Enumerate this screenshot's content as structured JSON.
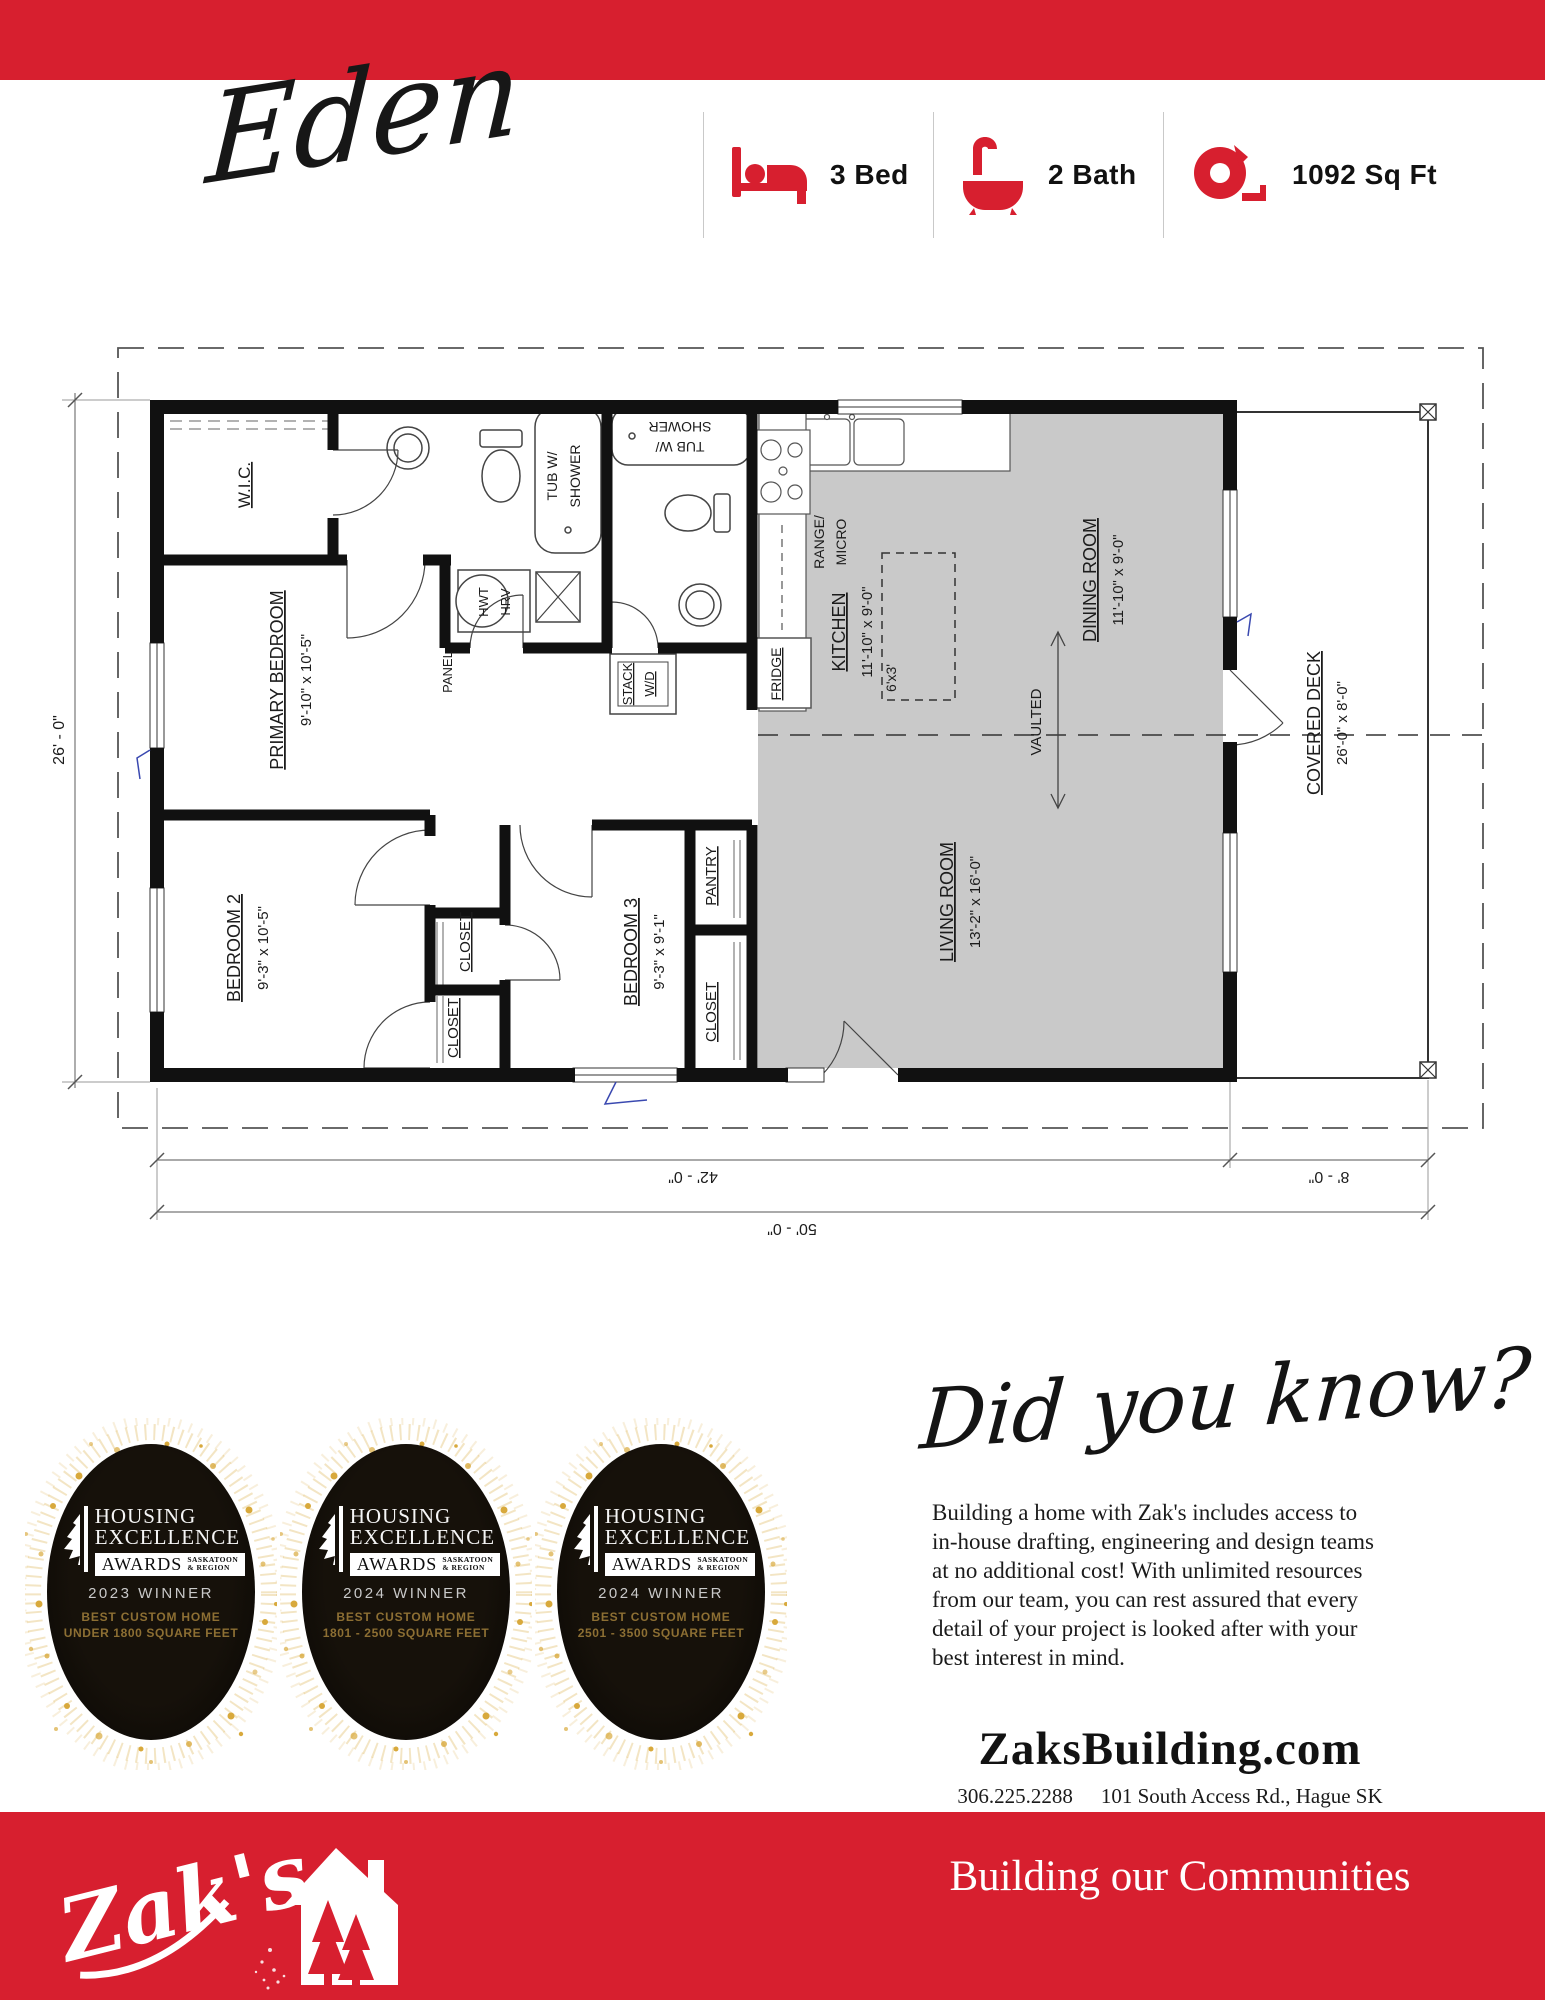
{
  "page": {
    "accent_color": "#d71f2f",
    "plan_gray": "#c9c9c9"
  },
  "header": {
    "plan_name": "Eden"
  },
  "specs": {
    "bed_label": "3 Bed",
    "bath_label": "2 Bath",
    "sqft_label": "1092 Sq Ft"
  },
  "plan": {
    "texts": [
      {
        "t": "W.I.C."
      },
      {
        "t": "PRIMARY BEDROOM"
      },
      {
        "t": "9'-10\" x 10'-5\""
      },
      {
        "t": "BEDROOM 2"
      },
      {
        "t": "9'-3\" x 10'-5\""
      },
      {
        "t": "BEDROOM 3"
      },
      {
        "t": "9'-3\" x 9'-1\""
      },
      {
        "t": "CLOSET"
      },
      {
        "t": "CLOSET"
      },
      {
        "t": "PANTRY"
      },
      {
        "t": "CLOSET"
      },
      {
        "t": "KITCHEN"
      },
      {
        "t": "11'-10\" x 9'-0\""
      },
      {
        "t": "6'x3'"
      },
      {
        "t": "DINING ROOM"
      },
      {
        "t": "11'-10\" x 9'-0\""
      },
      {
        "t": "LIVING ROOM"
      },
      {
        "t": "13'-2\" x 16'-0\""
      },
      {
        "t": "VAULTED"
      },
      {
        "t": "COVERED DECK"
      },
      {
        "t": "26'-0\" x 8'-0\""
      },
      {
        "t": "FRIDGE"
      },
      {
        "t": "RANGE/"
      },
      {
        "t": "MICRO"
      },
      {
        "t": "HWT"
      },
      {
        "t": "HRV"
      },
      {
        "t": "PANEL"
      },
      {
        "t": "STACK"
      },
      {
        "t": "W/D"
      },
      {
        "t": "TUB W/"
      },
      {
        "t": "SHOWER"
      },
      {
        "t": "SHOWER"
      },
      {
        "t": "TUB W/"
      },
      {
        "t": "26' - 0\""
      },
      {
        "t": "42' - 0\""
      },
      {
        "t": "8' - 0\""
      },
      {
        "t": "50' - 0\""
      }
    ]
  },
  "awards": {
    "badges": [
      {
        "t1": "HOUSING",
        "t2": "EXCELLENCE",
        "aw": "AWARDS",
        "r1": "SASKATOON",
        "r2": "& REGION",
        "winner": "2023 WINNER",
        "cat": "BEST CUSTOM HOME",
        "detail": "UNDER 1800 SQUARE FEET"
      },
      {
        "t1": "HOUSING",
        "t2": "EXCELLENCE",
        "aw": "AWARDS",
        "r1": "SASKATOON",
        "r2": "& REGION",
        "winner": "2024 WINNER",
        "cat": "BEST CUSTOM HOME",
        "detail": "1801 - 2500 SQUARE FEET"
      },
      {
        "t1": "HOUSING",
        "t2": "EXCELLENCE",
        "aw": "AWARDS",
        "r1": "SASKATOON",
        "r2": "& REGION",
        "winner": "2024 WINNER",
        "cat": "BEST CUSTOM HOME",
        "detail": "2501 - 3500 SQUARE FEET"
      }
    ]
  },
  "did_you_know": {
    "heading": "Did you know?",
    "body": "Building a home with Zak's includes access to in-house drafting, engineering and design teams at no additional cost! With unlimited resources from our team, you can rest assured that every detail of your project is looked after with your best interest in mind."
  },
  "contact": {
    "website": "ZaksBuilding.com",
    "phone": "306.225.2288",
    "address": "101 South Access Rd., Hague SK",
    "social_handle": "@ZaksBuilding"
  },
  "footer": {
    "logo_text": "Zak's",
    "tagline": "Building our Communities"
  }
}
